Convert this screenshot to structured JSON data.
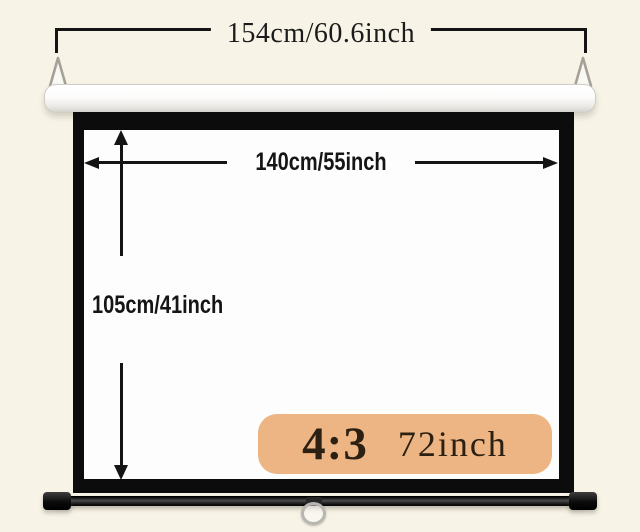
{
  "diagram": {
    "description": "pull-down projector screen dimension diagram",
    "total_width_label": "154cm/60.6inch",
    "viewable_width_label": "140cm/55inch",
    "viewable_height_label": "105cm/41inch",
    "badge": {
      "ratio": "4:3",
      "size": "72inch"
    }
  },
  "colors": {
    "page-bg": "#f7f3e6",
    "frame": "#0c0c0c",
    "arrow": "#141414",
    "badge-bg": "#ecb583",
    "badge-text": "#2b2012"
  }
}
